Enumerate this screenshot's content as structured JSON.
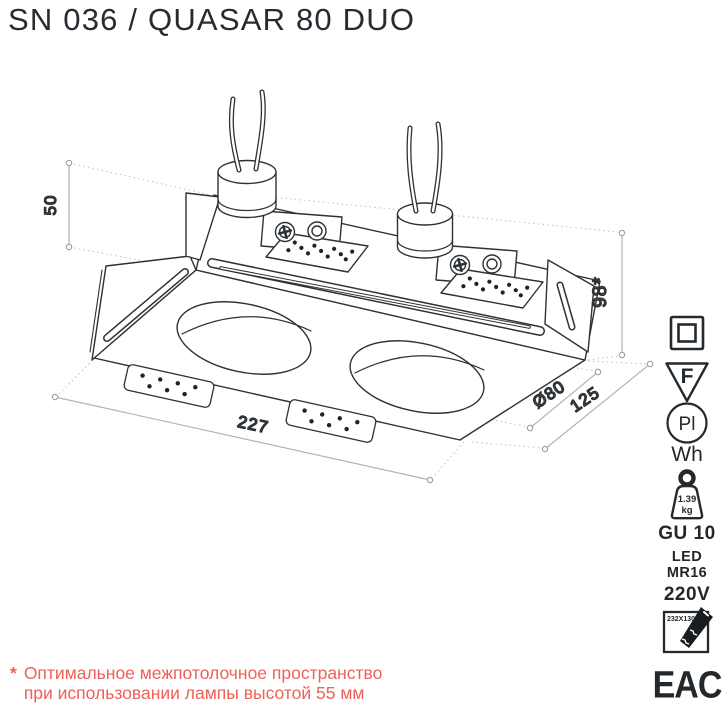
{
  "header": {
    "title": "SN 036 / QUASAR 80 DUO"
  },
  "drawing": {
    "dim_height_top": "50",
    "dim_recess": "98*",
    "dim_length": "227",
    "dim_width": "125",
    "dim_cutout": "Ø80"
  },
  "specs": {
    "f_mark": "F",
    "pl_mark": "Pl",
    "finish": "Wh",
    "weight_value": "1.39",
    "weight_unit": "kg",
    "socket": "GU 10",
    "lamp_line1": "LED",
    "lamp_line2": "MR16",
    "voltage": "220V",
    "cutout_size": "232X130",
    "cert": "EAC"
  },
  "footnote": {
    "marker": "*",
    "line1": "Оптимальное межпотолочное пространство",
    "line2": "при использовании лампы высотой 55 мм"
  },
  "colors": {
    "line": "#2d3236",
    "dim_gray": "#97999c",
    "red_dim": "#e2463c",
    "red_footnote": "#ee6158"
  }
}
